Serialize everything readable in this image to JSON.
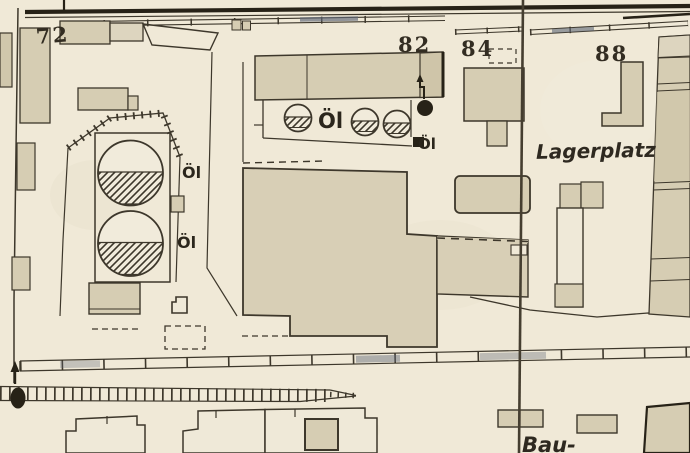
{
  "map": {
    "kind": "Historical site plan (scanned cadastral map)",
    "language": "German",
    "labels": {
      "parcel_72": "72",
      "parcel_82": "82",
      "parcel_84": "84",
      "parcel_88": "88",
      "storage_yard": "Lagerplatz",
      "building_site_partial": "Bau-",
      "oil_label_tank_row": "Öl",
      "oil_label_near_marker": "Öl",
      "oil_label_large_tank_upper": "Öl",
      "oil_label_large_tank_lower": "Öl"
    },
    "features": {
      "small_oil_tanks": 3,
      "large_oil_tanks": 2
    },
    "colors": {
      "paper": "#f0e9d7",
      "building_fill": "#d6cdb3",
      "building_fill_light": "#ddd5bf",
      "building_fill_dark": "#cfc5a9",
      "line_ink": "#3d372b",
      "heavy_ink": "#272217",
      "segment_tint": "#5f6878"
    }
  }
}
